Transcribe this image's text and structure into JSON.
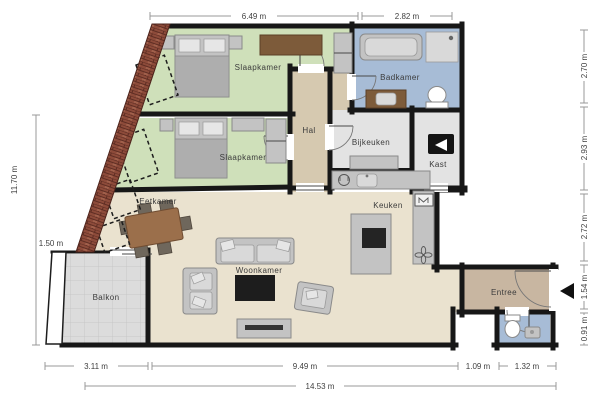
{
  "plan": {
    "title": "apartment-floor-plan",
    "rooms": {
      "slaapkamer1": "Slaapkamer",
      "slaapkamer2": "Slaapkamer",
      "badkamer": "Badkamer",
      "hal": "Hal",
      "bijkeuken": "Bijkeuken",
      "kast": "Kast",
      "keuken": "Keuken",
      "eetkamer": "Eetkamer",
      "woonkamer": "Woonkamer",
      "balkon": "Balkon",
      "entree": "Entree"
    },
    "dimensions": {
      "top_left": "6.49 m",
      "top_right": "2.82 m",
      "left_total": "11.70 m",
      "left_balcony": "1.50 m",
      "right_1": "2.70 m",
      "right_2": "2.93 m",
      "right_3": "2.72 m",
      "right_4": "1.54 m",
      "right_5": "0.91 m",
      "bottom_1": "3.11 m",
      "bottom_2": "9.49 m",
      "bottom_3": "1.09 m",
      "bottom_4": "1.32 m",
      "bottom_total": "14.53 m"
    },
    "colors": {
      "bedroom_floor": "#cfe0ba",
      "bathroom_floor": "#a7bcd6",
      "hall_floor": "#d6c9b0",
      "living_floor": "#eae2cf",
      "utility_floor": "#e3e3e3",
      "balcony_floor": "#dcdcdc",
      "entry_floor": "#c8b6a1",
      "wall": "#171717",
      "brick": "#8d4b3a"
    }
  }
}
